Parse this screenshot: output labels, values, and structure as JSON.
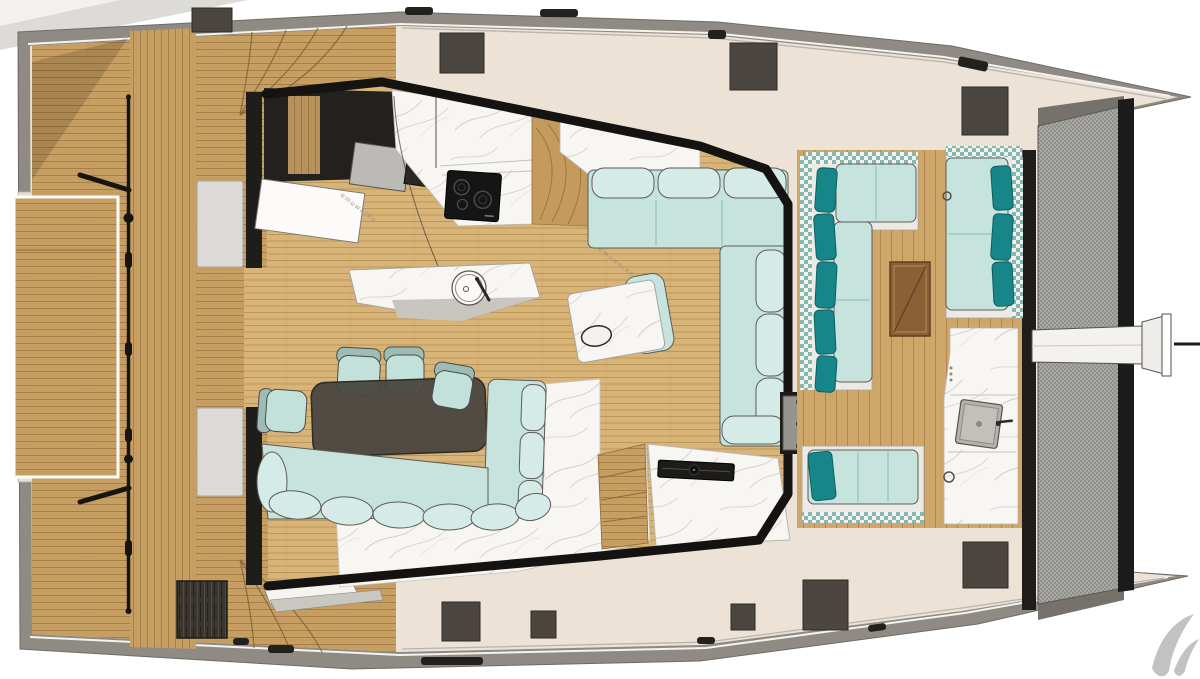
{
  "plan": {
    "type": "deck floor plan",
    "vessel": "catamaran yacht (top view)",
    "areas": [
      "aft swim platform",
      "aft deck",
      "salon",
      "galley",
      "dining area",
      "forward cockpit lounge",
      "wet bar",
      "trampoline",
      "bowsprit",
      "side decks"
    ],
    "furniture": [
      "induction cooktop with 3 burners",
      "round sink island",
      "dining table with 5 chairs",
      "L-shaped corner bench",
      "salon L-sofa",
      "marble side table",
      "forward L-sofa with teal pillows",
      "forward sofa with teal pillows",
      "wooden cocktail table",
      "sun bench with pillow",
      "square sink wet bar",
      "grill console",
      "deck hatches",
      "engine hatch"
    ]
  },
  "watermark": "emuwerke",
  "palette": {
    "background": "#ffffff",
    "deck": "#ece2d6",
    "gunwale": "#8f8b84",
    "frame_black": "#141311",
    "wood": "#c89f63",
    "wood_line": "#996f3c",
    "interior_wood": "#d8b478",
    "cockpit_wood": "#cfa76b",
    "marble": "#f7f6f3",
    "sofa": "#c6e3de",
    "sofa_bumper": "#d4ebe7",
    "pillow_teal": "#178689",
    "check_teal": "#84b8b1",
    "table_dark": "#4a4640",
    "wood_table": "#8a6136",
    "hatch": "#4b463f",
    "trampoline": "#a9a8a5",
    "appliance": "#bbbab6",
    "bench_gray": "#dbdad6",
    "cooktop": "#151515",
    "logo": "#c2c2c2"
  }
}
